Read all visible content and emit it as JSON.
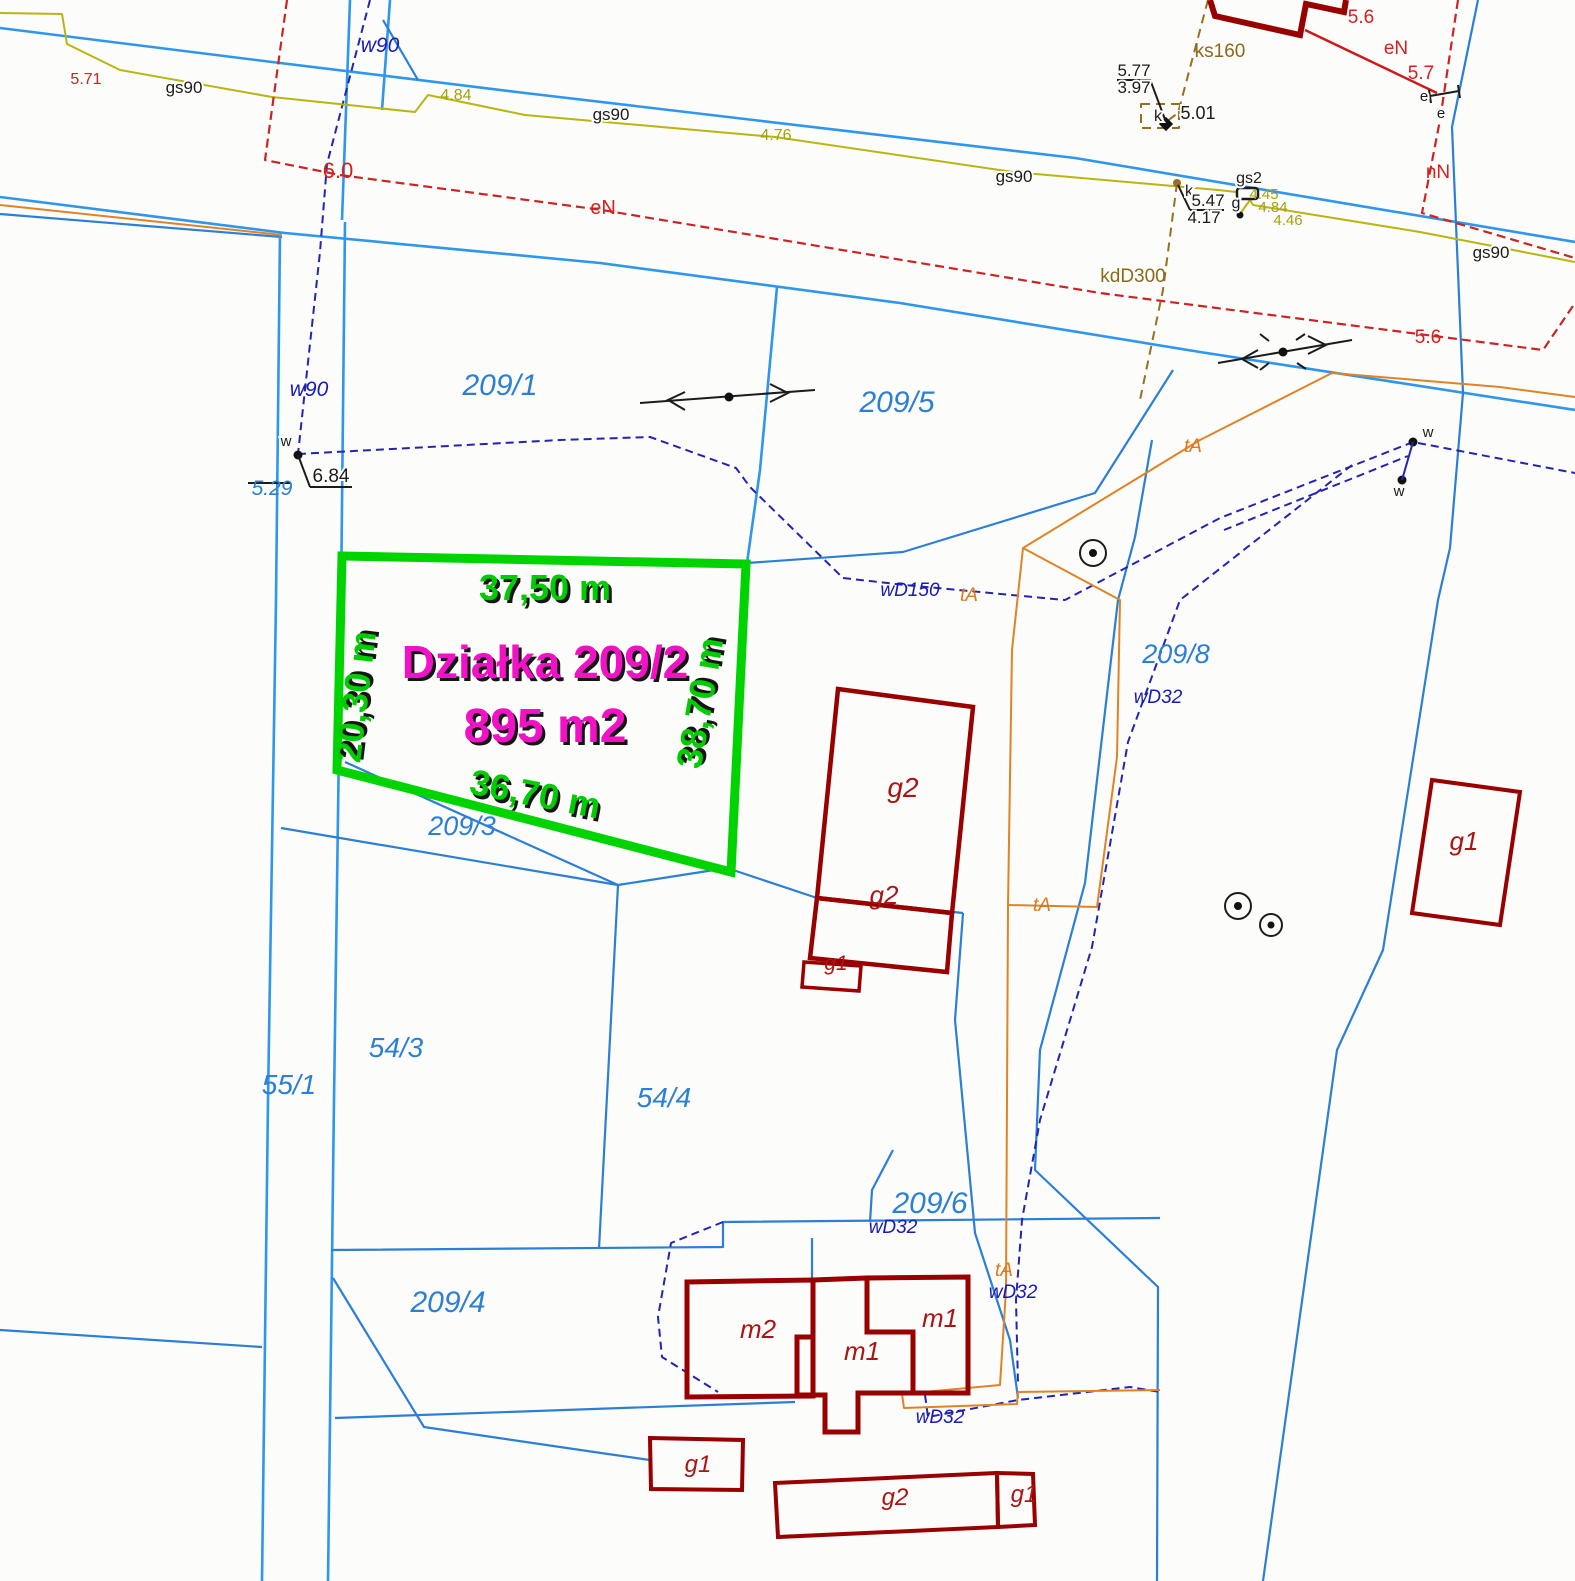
{
  "map": {
    "type": "cadastral-survey-map",
    "highlight_plot": {
      "name": "Działka 209/2",
      "area": "895 m2",
      "side_top": "37,50 m",
      "side_left": "20,30 m",
      "side_right": "38,70 m",
      "side_bottom": "36,70 m",
      "outline_color": "#00d400",
      "dimension_text_color": "#00cc00",
      "title_text_color": "#f012c4"
    },
    "legend_colors": {
      "parcel_boundary": "#2b7fd6",
      "water_line": "#2323b4",
      "gas_line": "#b9b511",
      "power_line": "#cc2424",
      "telecom_line": "#e08325",
      "sewer_line": "#96701e",
      "building_outline": "#990000"
    },
    "labels": [
      {
        "id": "dim-top",
        "t": "37,50 m",
        "x": 545,
        "y": 600,
        "s": 36,
        "c": "dim"
      },
      {
        "id": "dim-left",
        "t": "20,30 m",
        "x": 368,
        "y": 698,
        "s": 36,
        "c": "dim",
        "r": -83
      },
      {
        "id": "dim-right",
        "t": "38,70 m",
        "x": 712,
        "y": 705,
        "s": 36,
        "c": "dim",
        "r": -80
      },
      {
        "id": "dim-bottom",
        "t": "36,70 m",
        "x": 533,
        "y": 806,
        "s": 36,
        "c": "dim",
        "r": 11
      },
      {
        "id": "plot-title",
        "t": "Działka 209/2",
        "x": 545,
        "y": 678,
        "s": 46,
        "c": "area"
      },
      {
        "id": "plot-area",
        "t": "895 m2",
        "x": 545,
        "y": 742,
        "s": 48,
        "c": "area"
      },
      {
        "id": "parcel-209-1",
        "t": "209/1",
        "x": 500,
        "y": 395,
        "s": 30,
        "c": "parcel"
      },
      {
        "id": "parcel-209-5",
        "t": "209/5",
        "x": 897,
        "y": 412,
        "s": 30,
        "c": "parcel"
      },
      {
        "id": "parcel-209-8",
        "t": "209/8",
        "x": 1176,
        "y": 663,
        "s": 27,
        "c": "parcel"
      },
      {
        "id": "parcel-209-3",
        "t": "209/3",
        "x": 462,
        "y": 835,
        "s": 27,
        "c": "parcel"
      },
      {
        "id": "parcel-209-4",
        "t": "209/4",
        "x": 448,
        "y": 1312,
        "s": 30,
        "c": "parcel"
      },
      {
        "id": "parcel-209-6",
        "t": "209/6",
        "x": 930,
        "y": 1213,
        "s": 30,
        "c": "parcel"
      },
      {
        "id": "parcel-54-3",
        "t": "54/3",
        "x": 396,
        "y": 1057,
        "s": 28,
        "c": "parcel"
      },
      {
        "id": "parcel-54-4",
        "t": "54/4",
        "x": 664,
        "y": 1107,
        "s": 28,
        "c": "parcel"
      },
      {
        "id": "parcel-55-1",
        "t": "55/1",
        "x": 289,
        "y": 1094,
        "s": 28,
        "c": "parcel"
      },
      {
        "id": "elev-5-29",
        "t": "5.29",
        "x": 272,
        "y": 495,
        "s": 21,
        "c": "bluesm"
      },
      {
        "id": "w90-north",
        "t": "w90",
        "x": 380,
        "y": 52,
        "s": 21,
        "c": "navy"
      },
      {
        "id": "w90-mid",
        "t": "w90",
        "x": 309,
        "y": 396,
        "s": 21,
        "c": "navy"
      },
      {
        "id": "wd150",
        "t": "wD150",
        "x": 910,
        "y": 596,
        "s": 19,
        "c": "navy"
      },
      {
        "id": "wd32-a",
        "t": "wD32",
        "x": 1158,
        "y": 703,
        "s": 19,
        "c": "navy"
      },
      {
        "id": "wd32-b",
        "t": "wD32",
        "x": 893,
        "y": 1233,
        "s": 19,
        "c": "navy"
      },
      {
        "id": "wd32-c",
        "t": "wD32",
        "x": 1013,
        "y": 1298,
        "s": 19,
        "c": "navy"
      },
      {
        "id": "wd32-d",
        "t": "wD32",
        "x": 940,
        "y": 1423,
        "s": 19,
        "c": "navy"
      },
      {
        "id": "ta-a",
        "t": "tA",
        "x": 1193,
        "y": 452,
        "s": 19,
        "c": "orange"
      },
      {
        "id": "ta-b",
        "t": "tA",
        "x": 969,
        "y": 601,
        "s": 19,
        "c": "orange"
      },
      {
        "id": "ta-c",
        "t": "tA",
        "x": 1042,
        "y": 911,
        "s": 19,
        "c": "orange"
      },
      {
        "id": "ta-d",
        "t": "tA",
        "x": 1004,
        "y": 1276,
        "s": 19,
        "c": "orange"
      },
      {
        "id": "gas-4-84-a",
        "t": "4.84",
        "x": 456,
        "y": 100,
        "s": 16,
        "c": "yellow"
      },
      {
        "id": "gas-4-76",
        "t": "4.76",
        "x": 776,
        "y": 140,
        "s": 16,
        "c": "yellow"
      },
      {
        "id": "gas-4-45",
        "t": "4.45",
        "x": 1264,
        "y": 199,
        "s": 15,
        "c": "yellow"
      },
      {
        "id": "gas-4-84-b",
        "t": "4.84",
        "x": 1273,
        "y": 212,
        "s": 15,
        "c": "yellow"
      },
      {
        "id": "gas-4-46",
        "t": "4.46",
        "x": 1288,
        "y": 225,
        "s": 15,
        "c": "yellow"
      },
      {
        "id": "power-5-71",
        "t": "5.71",
        "x": 86,
        "y": 84,
        "s": 16,
        "c": "red"
      },
      {
        "id": "power-6-0",
        "t": "6.0",
        "x": 338,
        "y": 178,
        "s": 22,
        "c": "red"
      },
      {
        "id": "power-en-a",
        "t": "eN",
        "x": 603,
        "y": 214,
        "s": 20,
        "c": "red"
      },
      {
        "id": "power-5-6-top",
        "t": "5.6",
        "x": 1361,
        "y": 23,
        "s": 19,
        "c": "red"
      },
      {
        "id": "power-en-b",
        "t": "eN",
        "x": 1396,
        "y": 54,
        "s": 19,
        "c": "red"
      },
      {
        "id": "power-5-7",
        "t": "5.7",
        "x": 1421,
        "y": 79,
        "s": 19,
        "c": "red"
      },
      {
        "id": "power-nn",
        "t": "nN",
        "x": 1438,
        "y": 178,
        "s": 19,
        "c": "red"
      },
      {
        "id": "power-5-6-b",
        "t": "5.6",
        "x": 1428,
        "y": 343,
        "s": 19,
        "c": "red"
      },
      {
        "id": "gs90-a",
        "t": "gs90",
        "x": 184,
        "y": 93,
        "s": 17,
        "c": "black"
      },
      {
        "id": "gs90-b",
        "t": "gs90",
        "x": 611,
        "y": 120,
        "s": 17,
        "c": "black"
      },
      {
        "id": "gs90-c",
        "t": "gs90",
        "x": 1014,
        "y": 182,
        "s": 17,
        "c": "black"
      },
      {
        "id": "gs90-d",
        "t": "gs90",
        "x": 1491,
        "y": 258,
        "s": 17,
        "c": "black"
      },
      {
        "id": "elev-5-77",
        "t": "5.77",
        "x": 1134,
        "y": 76,
        "s": 17,
        "c": "black"
      },
      {
        "id": "elev-3-97",
        "t": "3.97",
        "x": 1134,
        "y": 93,
        "s": 17,
        "c": "black"
      },
      {
        "id": "elev-5-01",
        "t": "5.01",
        "x": 1198,
        "y": 119,
        "s": 18,
        "c": "black"
      },
      {
        "id": "well-k-a",
        "t": "k",
        "x": 1158,
        "y": 121,
        "s": 16,
        "c": "black"
      },
      {
        "id": "well-k-b",
        "t": "k",
        "x": 1189,
        "y": 196,
        "s": 16,
        "c": "black"
      },
      {
        "id": "elev-5-47",
        "t": "5.47",
        "x": 1208,
        "y": 206,
        "s": 17,
        "c": "black"
      },
      {
        "id": "elev-4-17",
        "t": "4.17",
        "x": 1204,
        "y": 223,
        "s": 17,
        "c": "black"
      },
      {
        "id": "gas-g",
        "t": "g",
        "x": 1236,
        "y": 208,
        "s": 16,
        "c": "black"
      },
      {
        "id": "gas-gs2",
        "t": "gs2",
        "x": 1249,
        "y": 183,
        "s": 16,
        "c": "black"
      },
      {
        "id": "elev-6-84",
        "t": "6.84",
        "x": 331,
        "y": 482,
        "s": 19,
        "c": "black"
      },
      {
        "id": "w-node-a",
        "t": "w",
        "x": 286,
        "y": 446,
        "s": 15,
        "c": "black"
      },
      {
        "id": "w-node-b",
        "t": "w",
        "x": 1428,
        "y": 437,
        "s": 15,
        "c": "black"
      },
      {
        "id": "w-node-c",
        "t": "w",
        "x": 1399,
        "y": 496,
        "s": 15,
        "c": "black"
      },
      {
        "id": "e-node-a",
        "t": "e",
        "x": 1424,
        "y": 101,
        "s": 15,
        "c": "black"
      },
      {
        "id": "e-node-b",
        "t": "e",
        "x": 1441,
        "y": 118,
        "s": 15,
        "c": "black"
      },
      {
        "id": "sewer-ks160",
        "t": "ks160",
        "x": 1220,
        "y": 57,
        "s": 19,
        "c": "brown"
      },
      {
        "id": "sewer-kdd300",
        "t": "kdD300",
        "x": 1133,
        "y": 282,
        "s": 19,
        "c": "brown"
      },
      {
        "id": "bld-g2-upper",
        "t": "g2",
        "x": 903,
        "y": 797,
        "s": 28,
        "c": "bld"
      },
      {
        "id": "bld-g2-lower",
        "t": "g2",
        "x": 884,
        "y": 904,
        "s": 26,
        "c": "bld"
      },
      {
        "id": "bld-g1-small",
        "t": "g1",
        "x": 836,
        "y": 970,
        "s": 21,
        "c": "bld"
      },
      {
        "id": "bld-g1-right",
        "t": "g1",
        "x": 1464,
        "y": 850,
        "s": 26,
        "c": "bld"
      },
      {
        "id": "bld-m2",
        "t": "m2",
        "x": 758,
        "y": 1338,
        "s": 26,
        "c": "bld"
      },
      {
        "id": "bld-m1-center",
        "t": "m1",
        "x": 862,
        "y": 1360,
        "s": 26,
        "c": "bld"
      },
      {
        "id": "bld-m1-right",
        "t": "m1",
        "x": 940,
        "y": 1327,
        "s": 26,
        "c": "bld"
      },
      {
        "id": "bld-g1-bottom",
        "t": "g1",
        "x": 698,
        "y": 1472,
        "s": 24,
        "c": "bld"
      },
      {
        "id": "bld-g2-long",
        "t": "g2",
        "x": 895,
        "y": 1505,
        "s": 24,
        "c": "bld"
      },
      {
        "id": "bld-g1-end",
        "t": "g1",
        "x": 1024,
        "y": 1502,
        "s": 24,
        "c": "bld"
      }
    ]
  }
}
